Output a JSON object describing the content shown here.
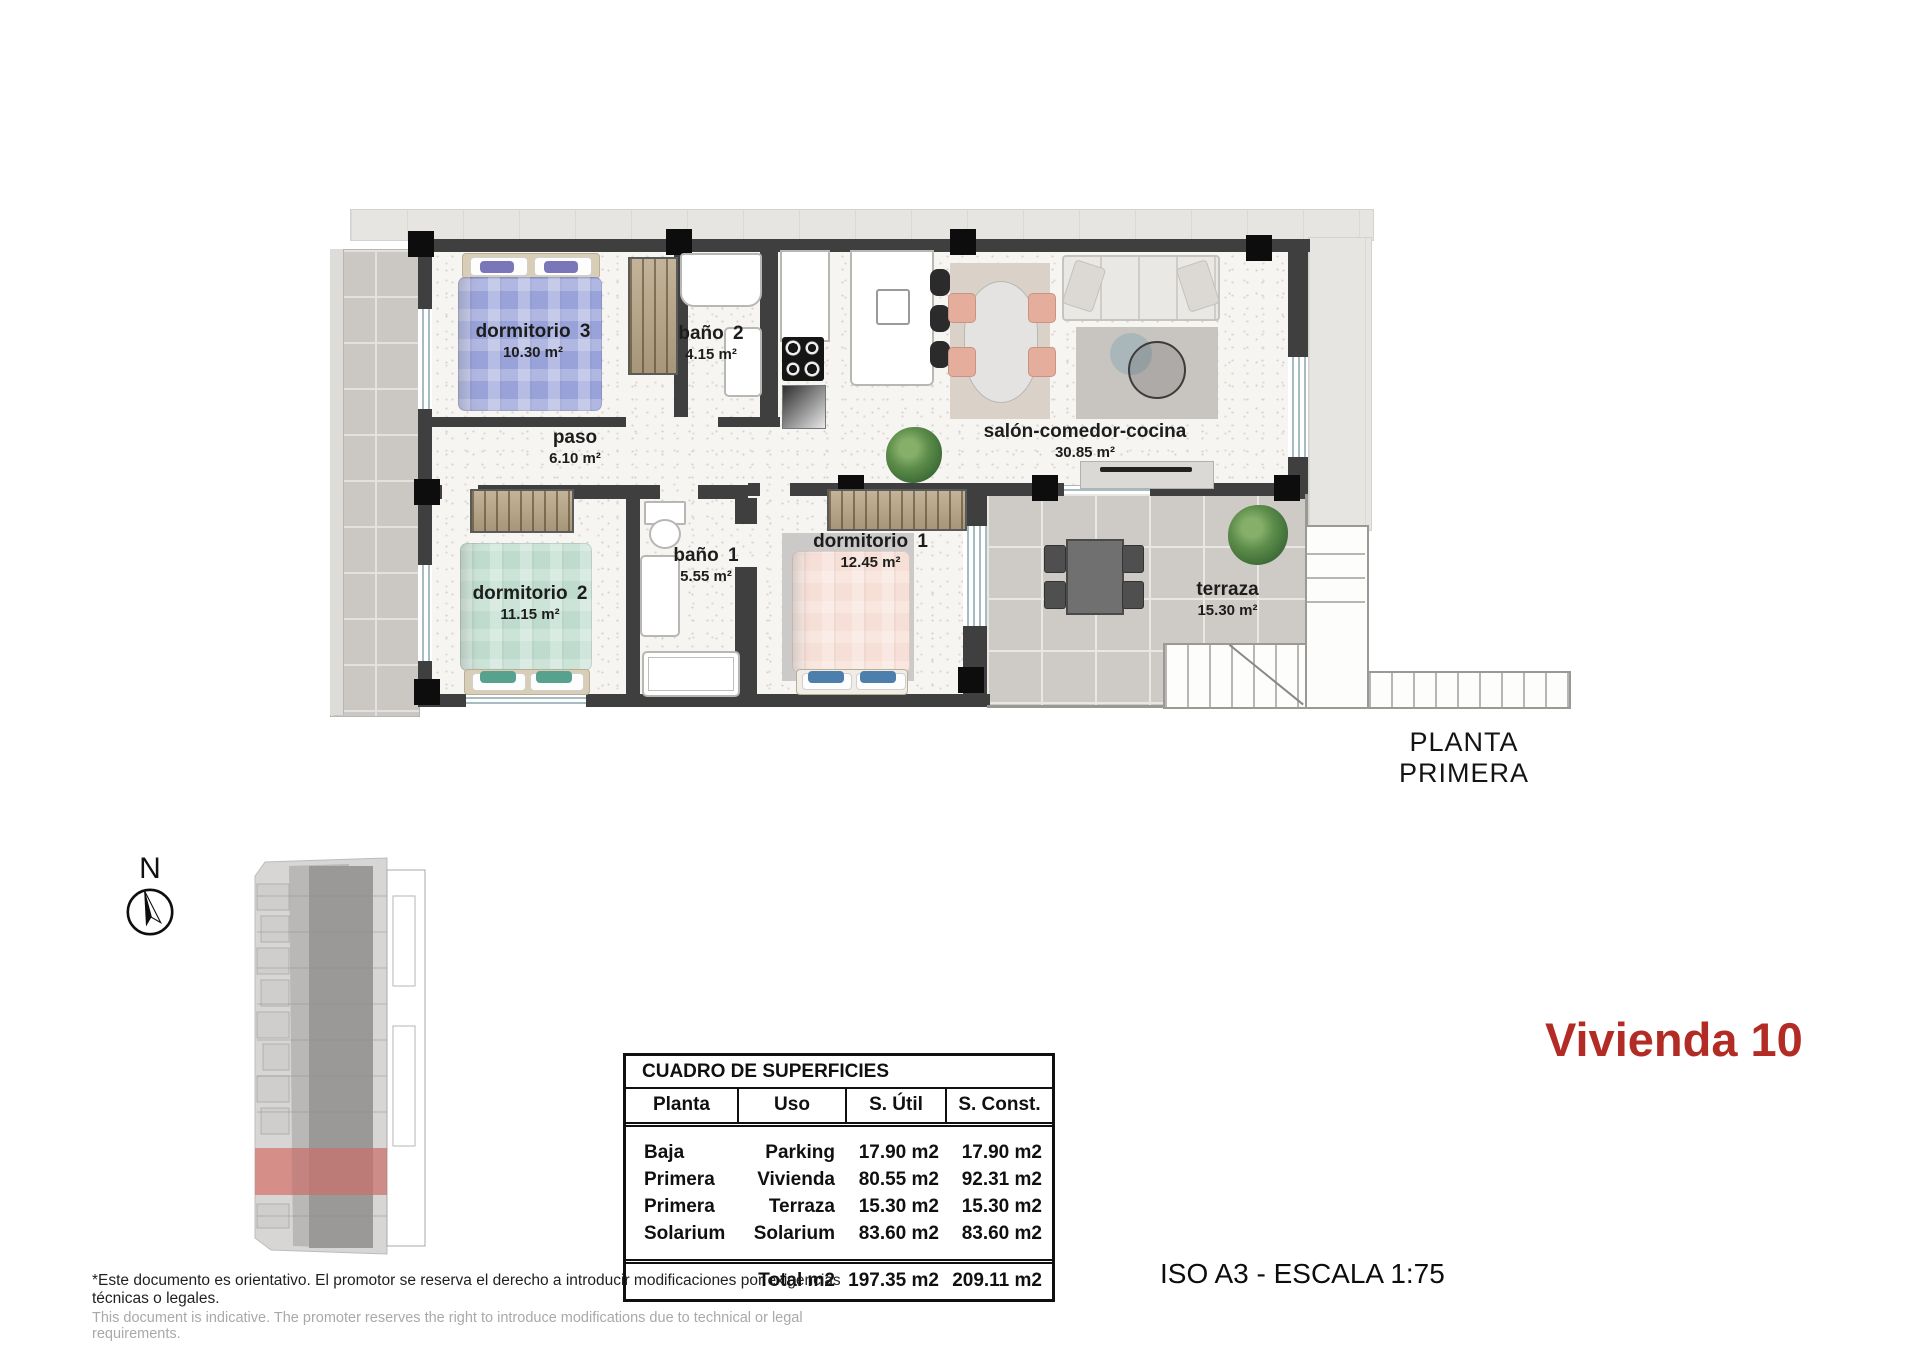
{
  "page": {
    "plan_title": "PLANTA PRIMERA",
    "unit_title": "Vivienda 10",
    "scale_note": "ISO A3 - ESCALA 1:75",
    "disclaimer_es": "*Este documento es orientativo. El promotor se reserva el derecho a introducir modificaciones por exigencias técnicas o legales.",
    "disclaimer_en": "This document is indicative. The promoter reserves the right to introduce modifications due to technical or legal requirements.",
    "north_label": "N"
  },
  "colors": {
    "accent_red": "#b22b24",
    "wall": "#3f3f3f",
    "highlighted_unit": "#c96f6a",
    "bed_blue": "#9aa3d9",
    "bed_green": "#bedbcd",
    "bed_pink": "#f6dfd6"
  },
  "rooms": {
    "dorm3": {
      "name": "dormitorio 3",
      "area": "10.30 m²"
    },
    "bano2": {
      "name": "baño 2",
      "area": "4.15 m²"
    },
    "paso": {
      "name": "paso",
      "area": "6.10 m²"
    },
    "salon": {
      "name": "salón-comedor-cocina",
      "area": "30.85 m²"
    },
    "dorm2": {
      "name": "dormitorio 2",
      "area": "11.15 m²"
    },
    "bano1": {
      "name": "baño 1",
      "area": "5.55 m²"
    },
    "dorm1": {
      "name": "dormitorio 1",
      "area": "12.45 m²"
    },
    "terraza": {
      "name": "terraza",
      "area": "15.30 m²"
    }
  },
  "surfaces_table": {
    "title": "CUADRO DE SUPERFICIES",
    "columns": [
      "Planta",
      "Uso",
      "S. Útil",
      "S. Const."
    ],
    "rows": [
      [
        "Baja",
        "Parking",
        "17.90 m2",
        "17.90 m2"
      ],
      [
        "Primera",
        "Vivienda",
        "80.55 m2",
        "92.31 m2"
      ],
      [
        "Primera",
        "Terraza",
        "15.30 m2",
        "15.30 m2"
      ],
      [
        "Solarium",
        "Solarium",
        "83.60 m2",
        "83.60 m2"
      ]
    ],
    "total_label": "Total m2",
    "total_util": "197.35 m2",
    "total_const": "209.11 m2"
  }
}
